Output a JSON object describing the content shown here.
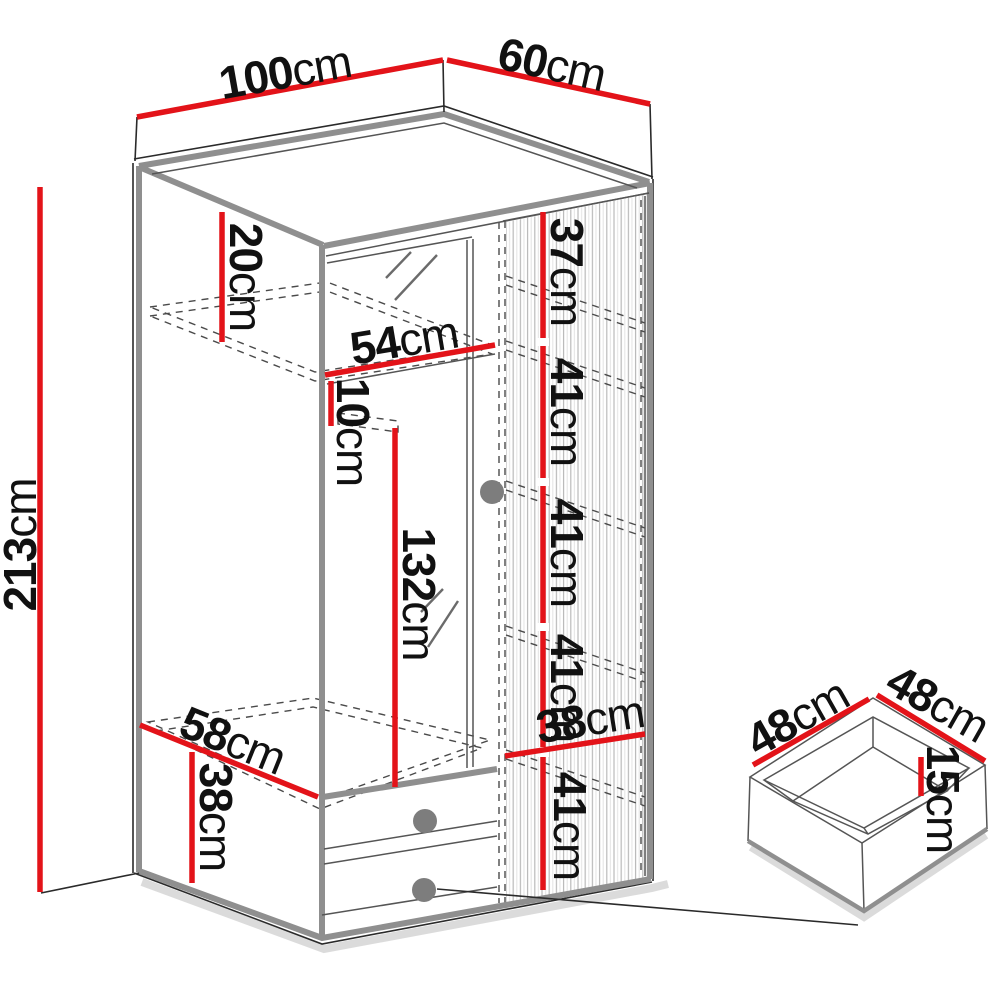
{
  "diagram": {
    "type": "furniture-dimension-drawing",
    "subject": "corner wardrobe with mirror door, fluted door, two drawers and detail view of a drawer box",
    "colors": {
      "dimension_red": "#e31319",
      "edge_gray": "#8f8f8f",
      "outline": "#1a1a1a"
    },
    "dims": {
      "top_width": {
        "v": "100",
        "u": "cm"
      },
      "top_depth": {
        "v": "60",
        "u": "cm"
      },
      "total_height": {
        "v": "213",
        "u": "cm"
      },
      "top_compartment": {
        "v": "20",
        "u": "cm"
      },
      "left_width": {
        "v": "54",
        "u": "cm"
      },
      "rail_gap": {
        "v": "10",
        "u": "cm"
      },
      "hanging_height": {
        "v": "132",
        "u": "cm"
      },
      "right_top": {
        "v": "37",
        "u": "cm"
      },
      "shelf_1": {
        "v": "41",
        "u": "cm"
      },
      "shelf_2": {
        "v": "41",
        "u": "cm"
      },
      "shelf_3": {
        "v": "41",
        "u": "cm"
      },
      "shelf_4": {
        "v": "41",
        "u": "cm"
      },
      "right_width": {
        "v": "38",
        "u": "cm"
      },
      "left_depth": {
        "v": "58",
        "u": "cm"
      },
      "bottom_section": {
        "v": "38",
        "u": "cm"
      },
      "drawer_width": {
        "v": "48",
        "u": "cm"
      },
      "drawer_depth": {
        "v": "48",
        "u": "cm"
      },
      "drawer_height": {
        "v": "15",
        "u": "cm"
      }
    }
  }
}
